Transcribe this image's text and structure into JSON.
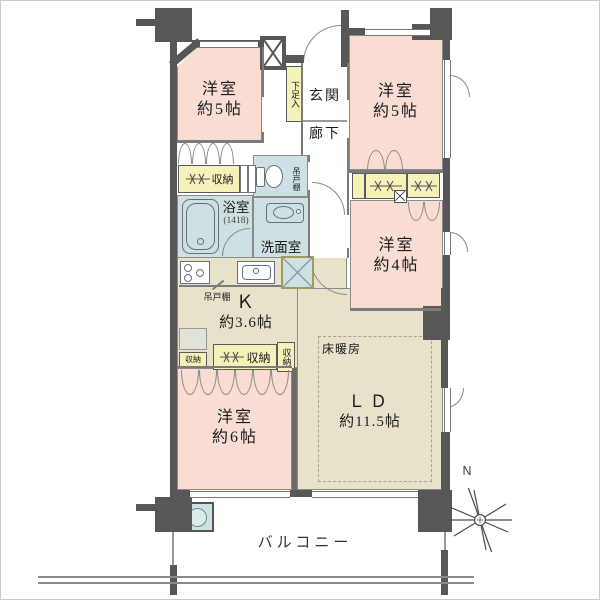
{
  "rooms": {
    "bedroom_nw": {
      "label": "洋室",
      "area": "約5帖"
    },
    "bedroom_ne": {
      "label": "洋室",
      "area": "約5帖"
    },
    "bedroom_e": {
      "label": "洋室",
      "area": "約4帖"
    },
    "bedroom_sw": {
      "label": "洋室",
      "area": "約6帖"
    },
    "living_dining": {
      "label": "ＬＤ",
      "area": "約11.5帖"
    },
    "kitchen": {
      "label": "Ｋ",
      "area": "約3.6帖"
    },
    "entrance": {
      "label": "玄関"
    },
    "hallway": {
      "label": "廊下"
    },
    "bathroom": {
      "label": "浴室",
      "size": "(1418)"
    },
    "washroom": {
      "label": "洗面室"
    },
    "balcony": {
      "label": "バルコニー"
    }
  },
  "fixtures": {
    "shoe_cabinet": "下足入",
    "hanging_shelf_wc": "吊戸棚",
    "hanging_shelf_kitchen": "吊戸棚",
    "floor_heating": "床暖房"
  },
  "storages": {
    "west": "収納",
    "sw_small": "収納",
    "sw_main": "収納",
    "sw_side": "収納"
  },
  "compass": {
    "north": "N"
  },
  "colors": {
    "wall": "#575757",
    "room_pink": "#f9ddd3",
    "ldk_beige": "#e8e2ca",
    "wet_blue": "#cfe0e3",
    "storage_yellow": "#f4f1b9",
    "line": "#8a8a8a"
  }
}
